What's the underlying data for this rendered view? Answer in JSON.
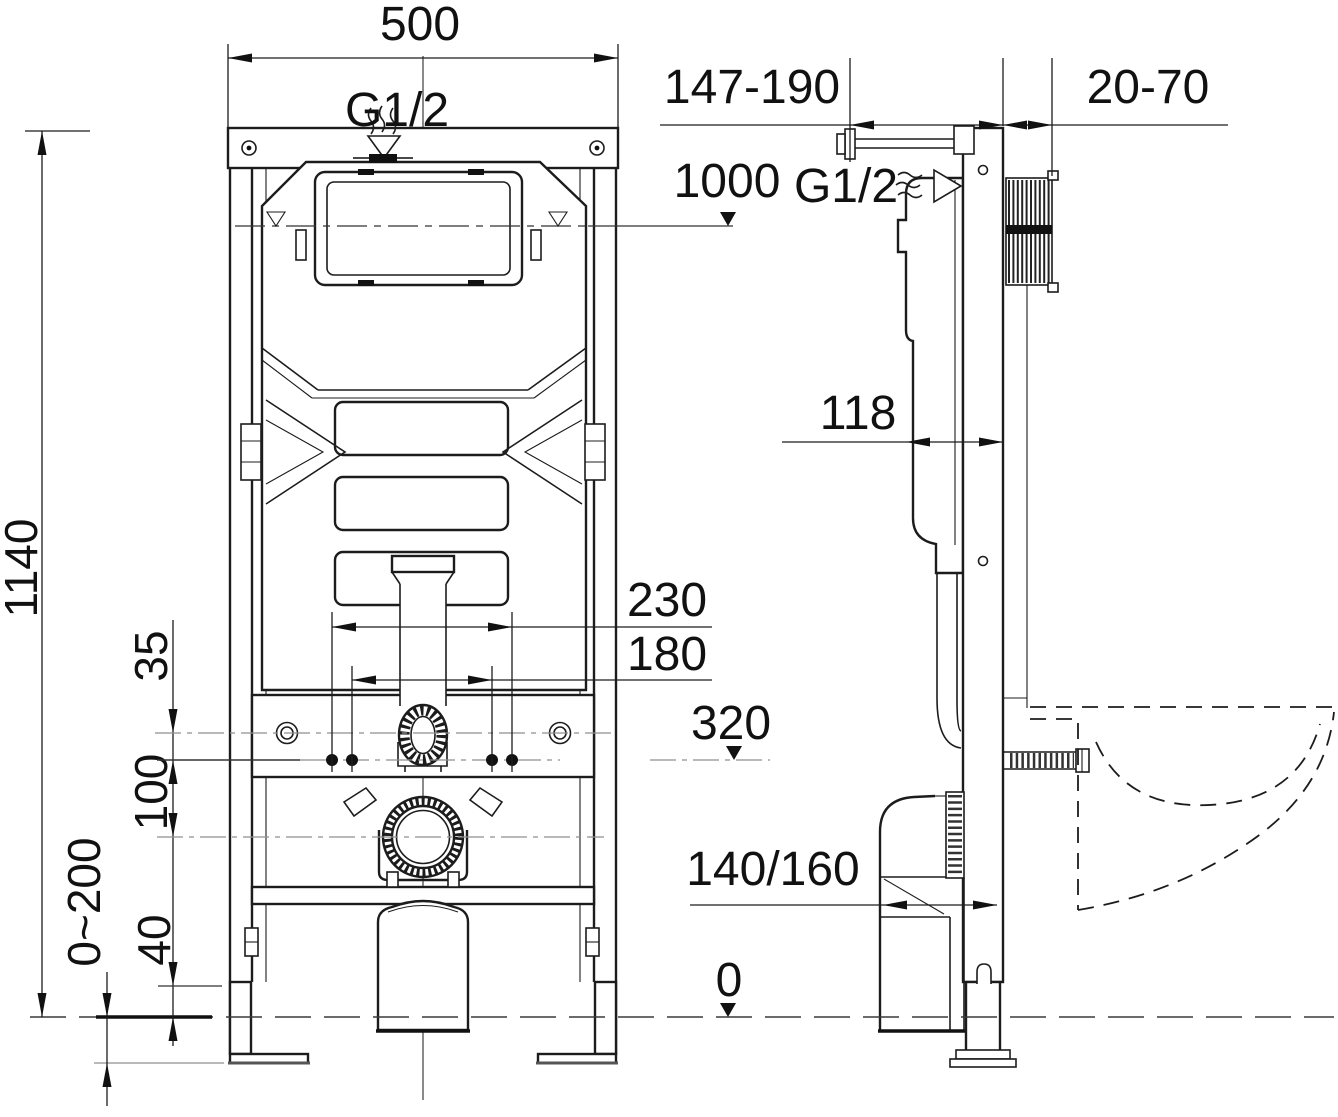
{
  "document": {
    "title": "Concealed cistern WC installation frame - dimensioned drawing, front and side view",
    "views": {
      "front": "front view",
      "side": "side view"
    }
  },
  "colors": {
    "line": "#1c1c1c",
    "reference": "#8f8f8f",
    "background": "#ffffff"
  },
  "labels": {
    "frame_width": "500",
    "inlet_thread_front": "G1/2",
    "total_height": "1140",
    "inlet_drop": "35",
    "inlet_to_drain": "100",
    "leg_adjustment": "0~200",
    "base_clearance": "40",
    "flush_level_height": "1000",
    "fixing_spacing_outer": "230",
    "fixing_spacing_inner": "180",
    "fixing_bolt_height": "320",
    "frame_to_wall_depth": "147-190",
    "wall_finish_thickness": "20-70",
    "inlet_thread_side": "G1/2",
    "cistern_depth": "118",
    "drain_outlet_size": "140/160",
    "floor_level": "0"
  }
}
